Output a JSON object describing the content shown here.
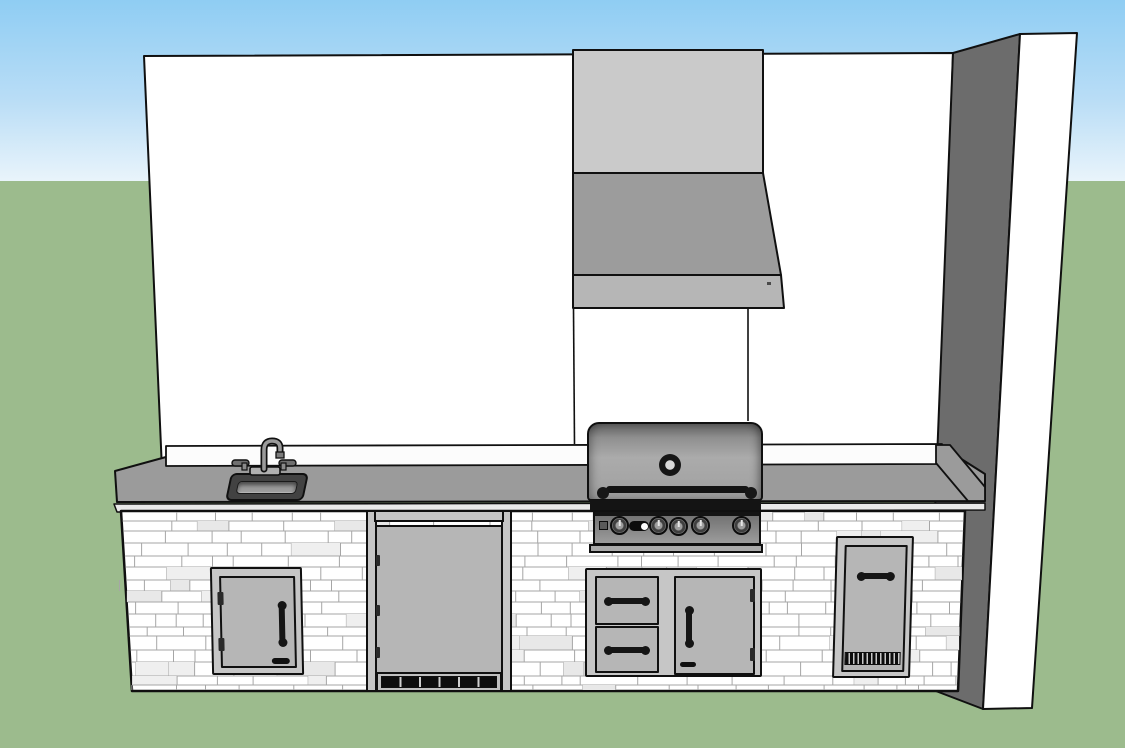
{
  "scene": {
    "type": "3d-model-render",
    "description": "Outdoor kitchen island elevation rendered in sketch style: stone-veneer base cabinet with stainless appliances against a white backdrop wall, grass ground and sky",
    "environment": {
      "sky": "clear gradient",
      "ground": "grass lawn"
    },
    "components": [
      {
        "name": "backdrop-wall",
        "material": "white painted"
      },
      {
        "name": "wall-return-panel",
        "shaded_face": true
      },
      {
        "name": "vent-hood-chimney"
      },
      {
        "name": "vent-hood-canopy"
      },
      {
        "name": "backsplash-ledge"
      },
      {
        "name": "countertop",
        "material": "gray solid surface"
      },
      {
        "name": "stone-veneer-island",
        "material": "white ashlar stone"
      },
      {
        "name": "sink-with-gooseneck-faucet",
        "handles": 2
      },
      {
        "name": "single-access-door",
        "hinge_side": "left",
        "handle": "vertical"
      },
      {
        "name": "outdoor-refrigerator",
        "vent_grille_sections": 6
      },
      {
        "name": "built-in-gas-grill",
        "burner_knobs": 5,
        "has_temperature_gauge": true,
        "has_ignition_button": true,
        "has_brand_badge": true
      },
      {
        "name": "drawer-and-door-combo",
        "drawers": 2,
        "doors": 1,
        "hinge_side": "right"
      },
      {
        "name": "vented-access-door",
        "handle": "horizontal",
        "vent_slats": true
      }
    ]
  },
  "colors": {
    "sky_top": "#8FCDF3",
    "sky_bottom": "#E9F4FB",
    "grass": "#9CBB8D",
    "wall": "#FFFFFF",
    "wall_shade": "#6C6C6C",
    "edge": "#101010",
    "chimney": "#CACACA",
    "canopy": "#9C9C9C",
    "canopy_band": "#B6B6B6",
    "counter": "#9B9B9B",
    "counter_fascia": "#E9E9E9",
    "splash": "#FCFCFC",
    "island_bg": "#FFFFFF",
    "stone_joint": "#A6A6A6",
    "steel_frame": "#C6C6C6",
    "steel_face": "#B6B6B6",
    "hood_hi": "#ABABAB",
    "hood_lo": "#5E5E5E",
    "metal_black": "#141414",
    "basin": "#9C9C9C",
    "basin_rim": "#424242"
  }
}
